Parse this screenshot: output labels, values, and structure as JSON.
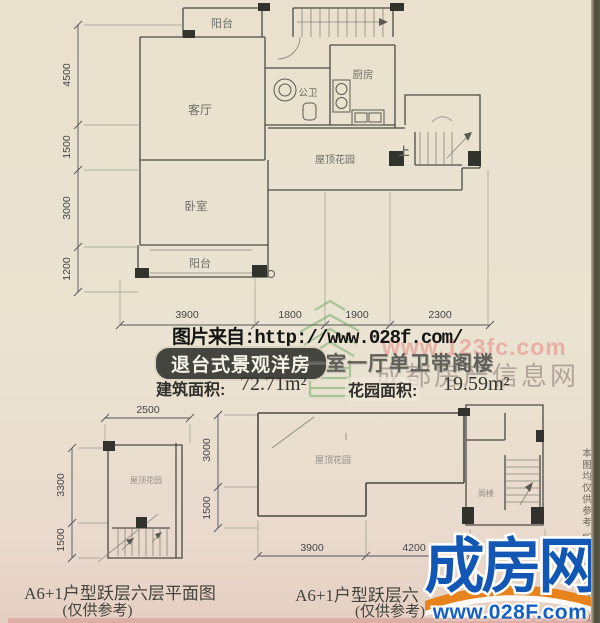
{
  "watermarks": {
    "source_line": "图片来自:http://www.028f.com/",
    "pink_url": "www.123fc.com",
    "site_name": "成都房产信息网",
    "side_note": "本图均仅供参考 所有细节及数据以"
  },
  "banner": {
    "tag": "退台式景观洋房",
    "subtitle": "一室一厅单卫带阁楼",
    "pill_bg": "#45453f",
    "built_area_label": "建筑面积:",
    "built_area_value": "72.71m²",
    "garden_area_label": "花园面积:",
    "garden_area_value": "19.59m²"
  },
  "main_plan": {
    "room_balcony_top": "阳台",
    "room_living": "客厅",
    "room_bath": "公卫",
    "room_kitchen": "厨房",
    "room_roof_garden": "屋顶花园",
    "room_bedroom": "卧室",
    "room_balcony_bottom": "阳台",
    "stair_up": "上",
    "dim_left_1": "4500",
    "dim_left_2": "1500",
    "dim_left_3": "3000",
    "dim_left_4": "1200",
    "dim_bottom_1": "3900",
    "dim_bottom_2": "1800",
    "dim_bottom_3": "1900",
    "dim_bottom_4": "2300"
  },
  "plan_six_left": {
    "caption_title": "A6+1户型跃层六层平面图",
    "caption_note": "(仅供参考)",
    "room_roof_garden": "屋顶花园",
    "dim_top": "2500",
    "dim_left_1": "3300",
    "dim_left_2": "1500"
  },
  "plan_six_right": {
    "caption_title": "A6+1户型跃层六",
    "caption_note": "(仅供参考)",
    "room_roof_garden": "屋顶花园",
    "room_loft": "阁楼",
    "dim_left_1": "3000",
    "dim_left_2": "1500",
    "dim_bottom_1": "3900",
    "dim_bottom_2": "4200"
  },
  "logo": {
    "name": "成房网",
    "url": "www.028F.com",
    "blue": "#1357b5",
    "orange": "#e8831c"
  }
}
